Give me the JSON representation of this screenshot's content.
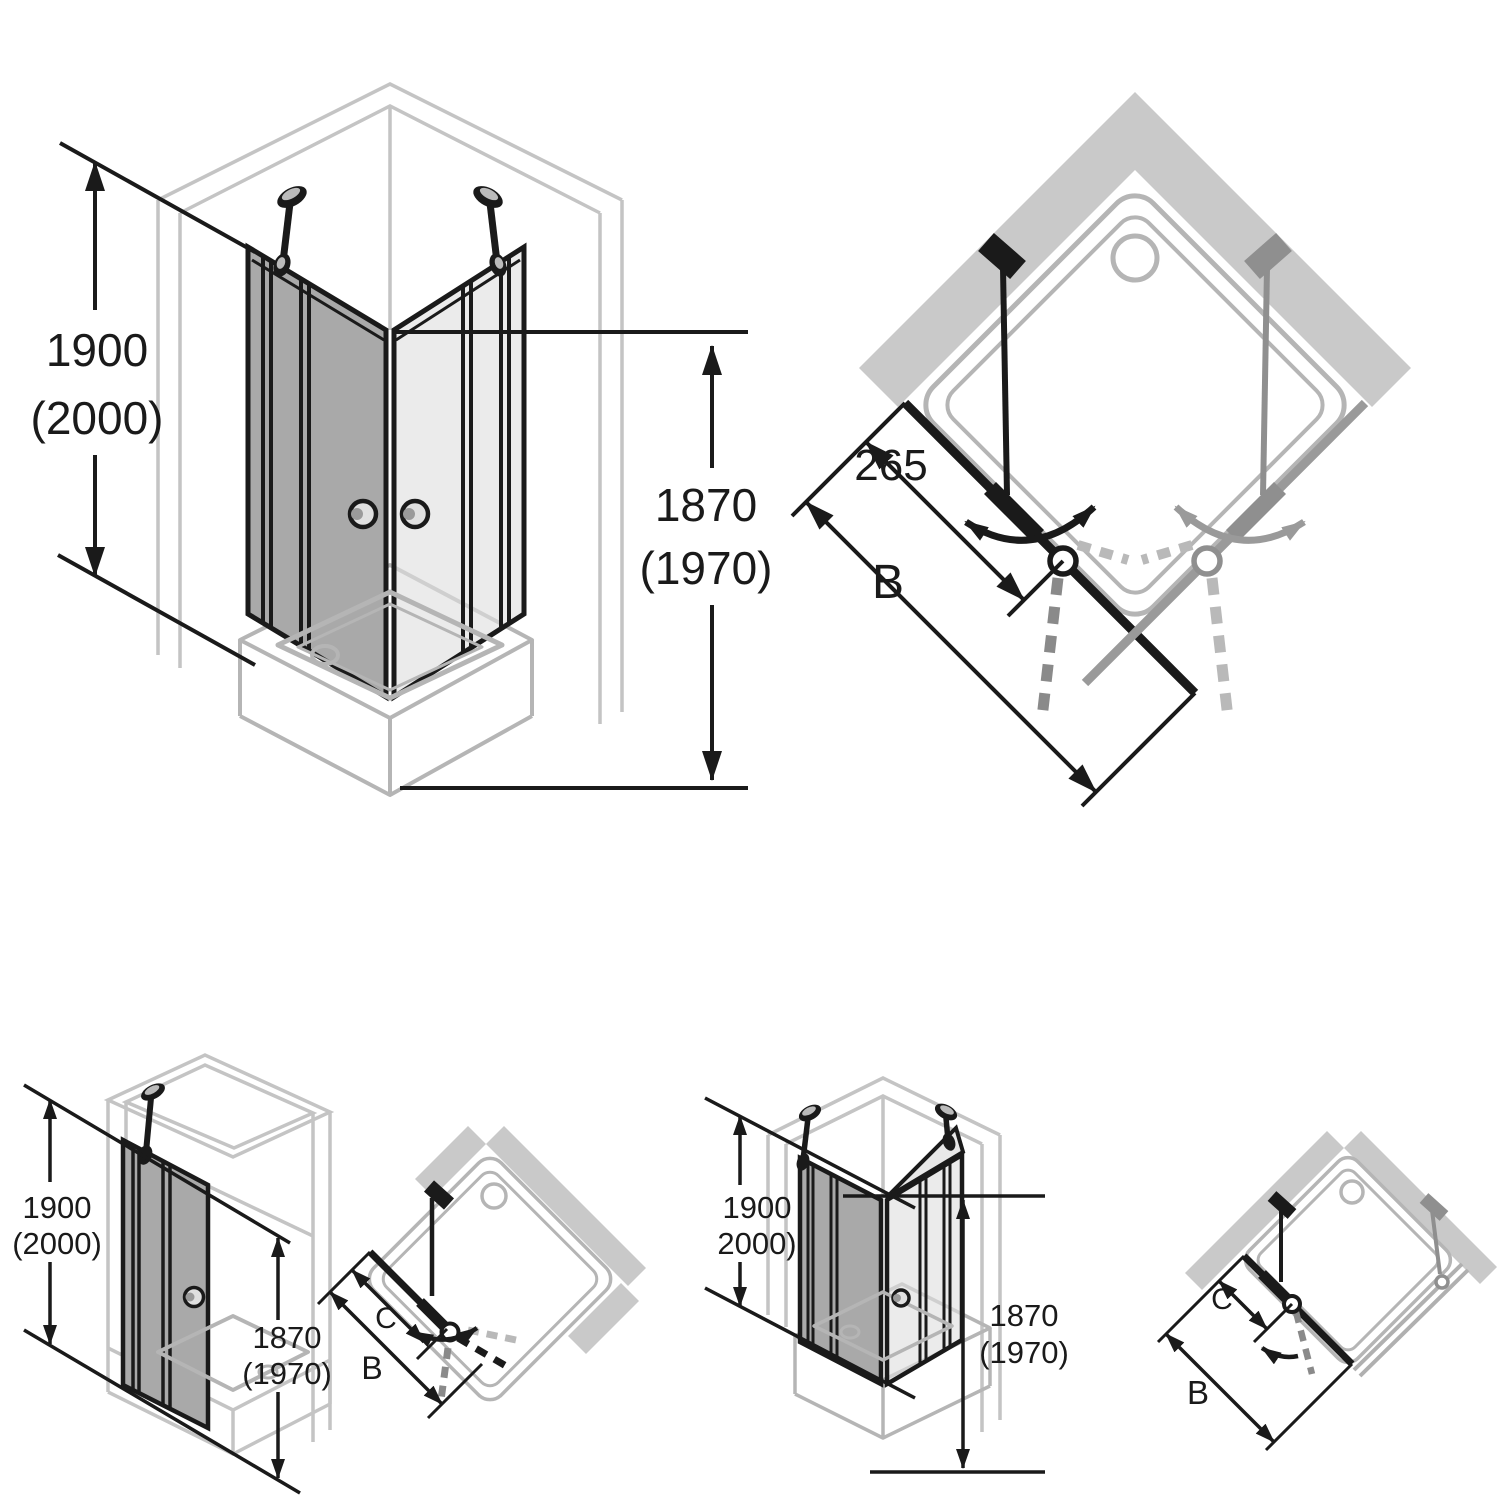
{
  "title": "Shower enclosure dimension diagrams",
  "colors": {
    "line": "#1a1a1a",
    "wall_outline": "#c4c4c4",
    "wall_fill": "#c9c9c9",
    "glass_dark": "#a9a9a9",
    "glass_light": "#dfdfdf",
    "tray": "#b5b5b5",
    "door_alt_gray": "#9a9a9a"
  },
  "diagrams": {
    "corner_entry_iso": {
      "height_total": [
        "1900",
        "(2000)"
      ],
      "height_door": [
        "1870",
        "(1970)"
      ]
    },
    "corner_entry_plan": {
      "pivot_offset": "265",
      "width": "B"
    },
    "niche_door_iso": {
      "height_total": [
        "1900",
        "(2000)"
      ],
      "height_door": [
        "1870",
        "(1970)"
      ]
    },
    "niche_door_plan": {
      "pivot_offset": "C",
      "width": "B"
    },
    "corner_door_iso": {
      "height_total": [
        "1900",
        "2000)"
      ],
      "height_door": [
        "1870",
        "(1970)"
      ]
    },
    "corner_door_plan": {
      "pivot_offset": "C",
      "width": "B"
    }
  }
}
